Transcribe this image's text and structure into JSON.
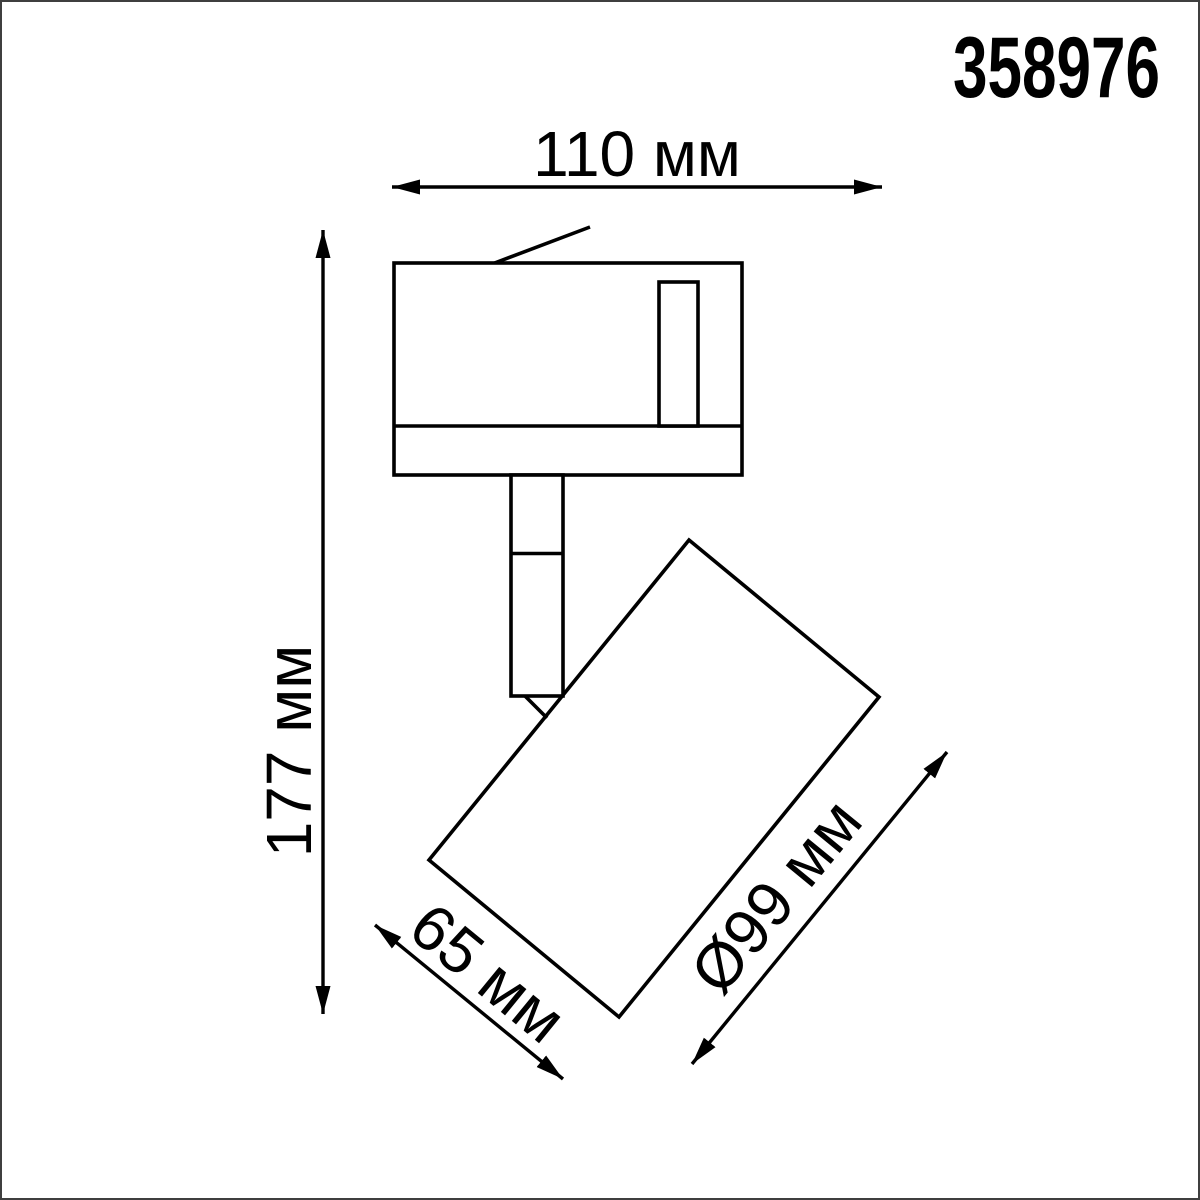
{
  "product": {
    "code": "358976"
  },
  "dimensions": {
    "overall_width": {
      "label": "110 мм",
      "value": 110,
      "unit": "мм"
    },
    "overall_height": {
      "label": "177 мм",
      "value": 177,
      "unit": "мм"
    },
    "head_length": {
      "label": "65 мм",
      "value": 65,
      "unit": "мм"
    },
    "head_diameter": {
      "label": "Ø99 мм",
      "value": 99,
      "unit": "мм"
    }
  },
  "colors": {
    "line": "#000000",
    "frame_border": "#3f3f3f",
    "background": "#ffffff"
  }
}
